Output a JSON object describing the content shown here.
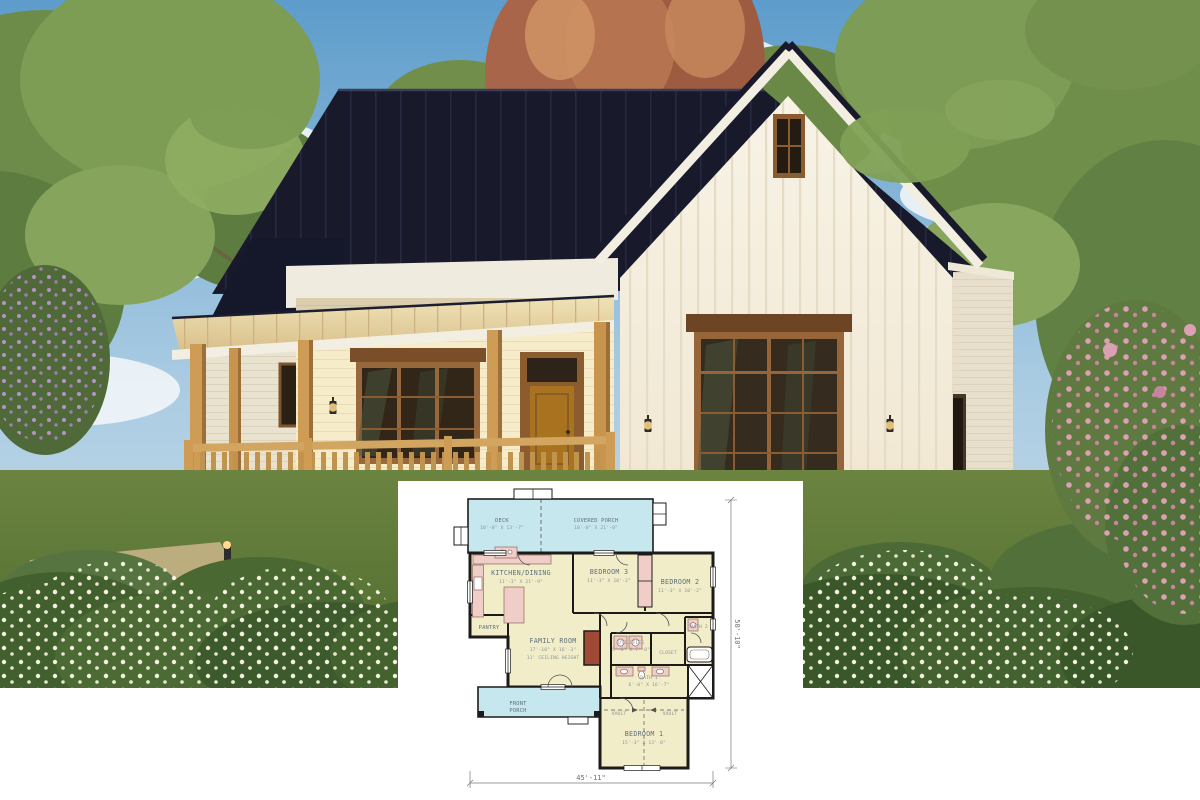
{
  "photo": {
    "colors": {
      "sky_top": "#5d9ccb",
      "sky_bottom": "#cfe0ea",
      "roof": "#181a2c",
      "wall_white": "#f5efe2",
      "wood_trim": "#96653a",
      "porch_wood": "#cf9c55",
      "porch_metal_roof": "#e9d9ac",
      "grass": "#5f7a38",
      "foliage_green": "#6f8e4a",
      "autumn_tree": "#a9654a",
      "pink_flowers": "#d795ac"
    }
  },
  "floor_plan": {
    "colors": {
      "room_fill": "#f2edc9",
      "porch_fill": "#c7e7ee",
      "fixture_fill": "#f0cec7",
      "fireplace_fill": "#a04a36",
      "wall": "#1d1b1a",
      "label_text": "#5f707a",
      "dim_text": "#8a959c"
    },
    "rooms": {
      "deck": {
        "name": "DECK",
        "dims": "10'-0\" X 13'-7\""
      },
      "covered_porch": {
        "name": "COVERED PORCH",
        "dims": "10'-0\" X 21'-0\""
      },
      "kitchen_dining": {
        "name": "KITCHEN/DINING",
        "dims": "11'-3\" X 21'-9\""
      },
      "bedroom3": {
        "name": "BEDROOM 3",
        "dims": "11'-3\" X 10'-2\""
      },
      "bedroom2": {
        "name": "BEDROOM 2",
        "dims": "11'-3\" X 10'-2\""
      },
      "pantry": {
        "name": "PANTRY"
      },
      "family_room": {
        "name": "FAMILY ROOM",
        "dims": "17'-10\" X 16'-3\"",
        "note": "11' CEILING HEIGHT"
      },
      "utilities": {
        "name": "UTILITIES",
        "dims": "5'-8\" X 7'-0\""
      },
      "closet": {
        "name": "CLOSET"
      },
      "bath2": {
        "name": "BATH 2"
      },
      "bath1": {
        "name": "BATH 1",
        "dims": "6'-0\" X 16'-7\""
      },
      "front_porch": {
        "line1": "FRONT",
        "line2": "PORCH"
      },
      "vault_left": "VAULT",
      "vault_right": "VAULT",
      "bedroom1": {
        "name": "BEDROOM 1",
        "dims": "15'-3\" X 13'-0\""
      }
    },
    "dimensions": {
      "overall_width": "45'-11\"",
      "overall_depth": "50'-10\""
    }
  }
}
